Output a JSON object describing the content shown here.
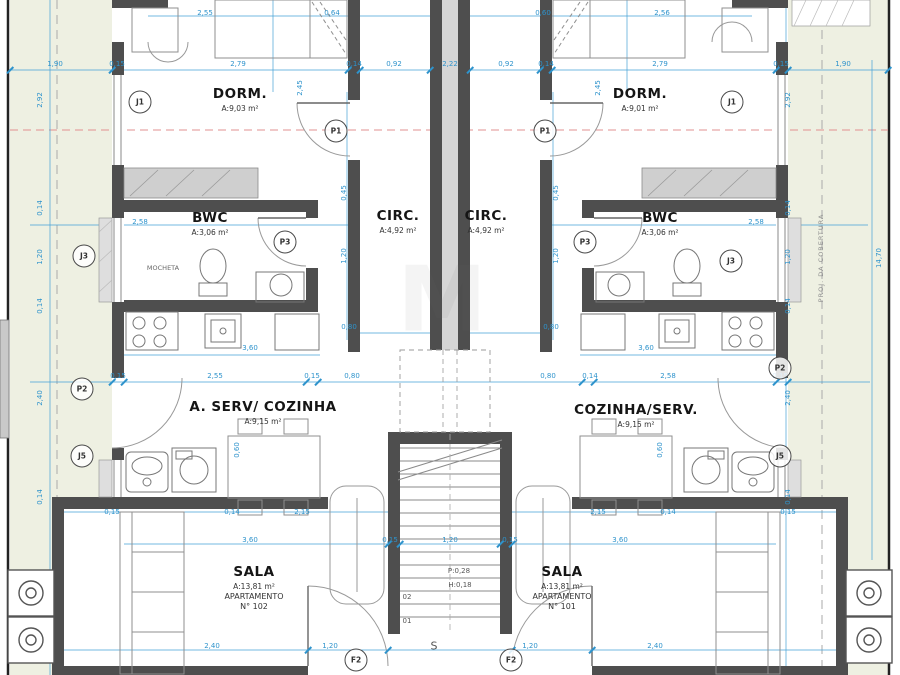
{
  "colors": {
    "margin_strip": "#eef0e2",
    "wall_gray": "#4e4e4e",
    "corridor_gray": "#d6d6d6",
    "dim_blue": "#2e93cc",
    "axis_red": "#e29090",
    "paper": "#ffffff"
  },
  "rooms": [
    {
      "n": "room-dorm-left",
      "label": "DORM.",
      "area": "A:9,03 m²",
      "x": 240,
      "y": 86
    },
    {
      "n": "room-dorm-right",
      "label": "DORM.",
      "area": "A:9,01 m²",
      "x": 640,
      "y": 86
    },
    {
      "n": "room-bwc-left",
      "label": "BWC",
      "area": "A:3,06 m²",
      "x": 210,
      "y": 210
    },
    {
      "n": "room-bwc-right",
      "label": "BWC",
      "area": "A:3,06 m²",
      "x": 660,
      "y": 210
    },
    {
      "n": "room-circ-left",
      "label": "CIRC.",
      "area": "A:4,92 m²",
      "x": 398,
      "y": 208
    },
    {
      "n": "room-circ-right",
      "label": "CIRC.",
      "area": "A:4,92 m²",
      "x": 486,
      "y": 208
    },
    {
      "n": "room-serv-left",
      "label": "A. SERV/ COZINHA",
      "area": "A:9,15 m²",
      "x": 263,
      "y": 399
    },
    {
      "n": "room-serv-right",
      "label": "COZINHA/SERV.",
      "area": "A:9,15 m²",
      "x": 636,
      "y": 402
    },
    {
      "n": "room-sala-left",
      "label": "SALA",
      "area": "A:13,81 m²",
      "l3": "APARTAMENTO",
      "l4": "N° 102",
      "x": 254,
      "y": 564
    },
    {
      "n": "room-sala-right",
      "label": "SALA",
      "area": "A:13,81 m²",
      "l3": "APARTAMENTO",
      "l4": "N° 101",
      "x": 562,
      "y": 564
    }
  ],
  "bubbles": [
    {
      "n": "bubble-j1-left",
      "t": "J1",
      "x": 140,
      "y": 102
    },
    {
      "n": "bubble-j1-right",
      "t": "J1",
      "x": 732,
      "y": 102
    },
    {
      "n": "bubble-p1-left",
      "t": "P1",
      "x": 336,
      "y": 131
    },
    {
      "n": "bubble-p1-right",
      "t": "P1",
      "x": 545,
      "y": 131
    },
    {
      "n": "bubble-p3-left",
      "t": "P3",
      "x": 285,
      "y": 242
    },
    {
      "n": "bubble-p3-right",
      "t": "P3",
      "x": 585,
      "y": 242
    },
    {
      "n": "bubble-j3-left",
      "t": "J3",
      "x": 84,
      "y": 256
    },
    {
      "n": "bubble-j3-right",
      "t": "J3",
      "x": 731,
      "y": 261
    },
    {
      "n": "bubble-p2-left",
      "t": "P2",
      "x": 82,
      "y": 389
    },
    {
      "n": "bubble-p2-right",
      "t": "P2",
      "x": 780,
      "y": 368
    },
    {
      "n": "bubble-j5-left",
      "t": "J5",
      "x": 82,
      "y": 456
    },
    {
      "n": "bubble-j5-right",
      "t": "J5",
      "x": 780,
      "y": 456
    },
    {
      "n": "bubble-f2-left",
      "t": "F2",
      "x": 356,
      "y": 660
    },
    {
      "n": "bubble-f2-right",
      "t": "F2",
      "x": 511,
      "y": 660
    }
  ],
  "dims": [
    {
      "t": "2,55",
      "x": 205,
      "y": 13
    },
    {
      "t": "0,64",
      "x": 332,
      "y": 13
    },
    {
      "t": "0,60",
      "x": 543,
      "y": 13
    },
    {
      "t": "2,56",
      "x": 662,
      "y": 13
    },
    {
      "t": "1,90",
      "x": 55,
      "y": 64
    },
    {
      "t": "0,15",
      "x": 117,
      "y": 64
    },
    {
      "t": "2,79",
      "x": 238,
      "y": 64
    },
    {
      "t": "0,14",
      "x": 354,
      "y": 64
    },
    {
      "t": "0,92",
      "x": 394,
      "y": 64
    },
    {
      "t": "2,22",
      "x": 450,
      "y": 64
    },
    {
      "t": "0,92",
      "x": 506,
      "y": 64
    },
    {
      "t": "0,14",
      "x": 546,
      "y": 64
    },
    {
      "t": "2,79",
      "x": 660,
      "y": 64
    },
    {
      "t": "0,15",
      "x": 781,
      "y": 64
    },
    {
      "t": "1,90",
      "x": 843,
      "y": 64
    },
    {
      "t": "2,45",
      "x": 300,
      "y": 88,
      "r": -90
    },
    {
      "t": "2,45",
      "x": 598,
      "y": 88,
      "r": -90
    },
    {
      "t": "2,92",
      "x": 40,
      "y": 100,
      "r": -90
    },
    {
      "t": "2,92",
      "x": 788,
      "y": 100,
      "r": -90
    },
    {
      "t": "0,14",
      "x": 40,
      "y": 208,
      "r": -90
    },
    {
      "t": "1,20",
      "x": 40,
      "y": 257,
      "r": -90
    },
    {
      "t": "0,14",
      "x": 40,
      "y": 306,
      "r": -90
    },
    {
      "t": "2,40",
      "x": 40,
      "y": 398,
      "r": -90
    },
    {
      "t": "0,14",
      "x": 40,
      "y": 497,
      "r": -90
    },
    {
      "t": "0,14",
      "x": 788,
      "y": 208,
      "r": -90
    },
    {
      "t": "1,20",
      "x": 788,
      "y": 257,
      "r": -90
    },
    {
      "t": "0,14",
      "x": 788,
      "y": 306,
      "r": -90
    },
    {
      "t": "2,40",
      "x": 788,
      "y": 398,
      "r": -90
    },
    {
      "t": "0,14",
      "x": 788,
      "y": 497,
      "r": -90
    },
    {
      "t": "14,70",
      "x": 879,
      "y": 258,
      "r": -90
    },
    {
      "t": "2,58",
      "x": 140,
      "y": 222
    },
    {
      "t": "2,58",
      "x": 756,
      "y": 222
    },
    {
      "t": "0,45",
      "x": 344,
      "y": 193,
      "r": -90
    },
    {
      "t": "0,45",
      "x": 556,
      "y": 193,
      "r": -90
    },
    {
      "t": "1,20",
      "x": 344,
      "y": 256,
      "r": -90
    },
    {
      "t": "1,20",
      "x": 556,
      "y": 256,
      "r": -90
    },
    {
      "t": "0,80",
      "x": 349,
      "y": 327
    },
    {
      "t": "0,80",
      "x": 551,
      "y": 327
    },
    {
      "t": "3,60",
      "x": 250,
      "y": 348
    },
    {
      "t": "3,60",
      "x": 646,
      "y": 348
    },
    {
      "t": "0,15",
      "x": 118,
      "y": 376
    },
    {
      "t": "2,55",
      "x": 215,
      "y": 376
    },
    {
      "t": "0,15",
      "x": 312,
      "y": 376
    },
    {
      "t": "0,80",
      "x": 352,
      "y": 376
    },
    {
      "t": "0,80",
      "x": 548,
      "y": 376
    },
    {
      "t": "0,14",
      "x": 590,
      "y": 376
    },
    {
      "t": "2,58",
      "x": 668,
      "y": 376
    },
    {
      "t": "0,15",
      "x": 780,
      "y": 376
    },
    {
      "t": "0,60",
      "x": 237,
      "y": 450,
      "r": -90
    },
    {
      "t": "0,60",
      "x": 660,
      "y": 450,
      "r": -90
    },
    {
      "t": "0,15",
      "x": 112,
      "y": 512
    },
    {
      "t": "0,14",
      "x": 232,
      "y": 512
    },
    {
      "t": "2,15",
      "x": 302,
      "y": 512
    },
    {
      "t": "2,15",
      "x": 598,
      "y": 512
    },
    {
      "t": "0,14",
      "x": 668,
      "y": 512
    },
    {
      "t": "0,15",
      "x": 788,
      "y": 512
    },
    {
      "t": "3,60",
      "x": 250,
      "y": 540
    },
    {
      "t": "0,15",
      "x": 390,
      "y": 540
    },
    {
      "t": "1,20",
      "x": 450,
      "y": 540
    },
    {
      "t": "0,15",
      "x": 510,
      "y": 540
    },
    {
      "t": "3,60",
      "x": 620,
      "y": 540
    },
    {
      "t": "2,40",
      "x": 212,
      "y": 646
    },
    {
      "t": "1,20",
      "x": 330,
      "y": 646
    },
    {
      "t": "1,20",
      "x": 530,
      "y": 646
    },
    {
      "t": "2,40",
      "x": 655,
      "y": 646
    }
  ],
  "ticks": [
    {
      "x": 10,
      "y": 70
    },
    {
      "x": 112,
      "y": 70
    },
    {
      "x": 348,
      "y": 70
    },
    {
      "x": 360,
      "y": 70
    },
    {
      "x": 430,
      "y": 70
    },
    {
      "x": 470,
      "y": 70
    },
    {
      "x": 540,
      "y": 70
    },
    {
      "x": 552,
      "y": 70
    },
    {
      "x": 776,
      "y": 70
    },
    {
      "x": 788,
      "y": 70
    },
    {
      "x": 888,
      "y": 70
    },
    {
      "x": 112,
      "y": 382
    },
    {
      "x": 124,
      "y": 382
    },
    {
      "x": 306,
      "y": 382
    },
    {
      "x": 318,
      "y": 382
    },
    {
      "x": 582,
      "y": 382
    },
    {
      "x": 594,
      "y": 382
    },
    {
      "x": 776,
      "y": 382
    },
    {
      "x": 788,
      "y": 382
    },
    {
      "x": 388,
      "y": 544
    },
    {
      "x": 400,
      "y": 544
    },
    {
      "x": 500,
      "y": 544
    },
    {
      "x": 512,
      "y": 544
    },
    {
      "x": 308,
      "y": 650
    },
    {
      "x": 388,
      "y": 650
    },
    {
      "x": 512,
      "y": 650
    },
    {
      "x": 592,
      "y": 650
    }
  ],
  "texts": [
    {
      "t": "MOCHETA",
      "x": 163,
      "y": 268,
      "c": "tiny"
    },
    {
      "t": "P:0,28",
      "x": 459,
      "y": 571,
      "c": "stair"
    },
    {
      "t": "H:0,18",
      "x": 460,
      "y": 585,
      "c": "stair"
    },
    {
      "t": "02",
      "x": 407,
      "y": 597,
      "c": "stair"
    },
    {
      "t": "01",
      "x": 407,
      "y": 621,
      "c": "stair"
    },
    {
      "t": "S",
      "x": 434,
      "y": 646,
      "c": "sbig"
    },
    {
      "t": "PROJ. DA COBERTURA",
      "x": 821,
      "y": 258,
      "r": -90,
      "c": "proj"
    },
    {
      "t": "M",
      "x": 442,
      "y": 300,
      "c": "wm"
    }
  ]
}
